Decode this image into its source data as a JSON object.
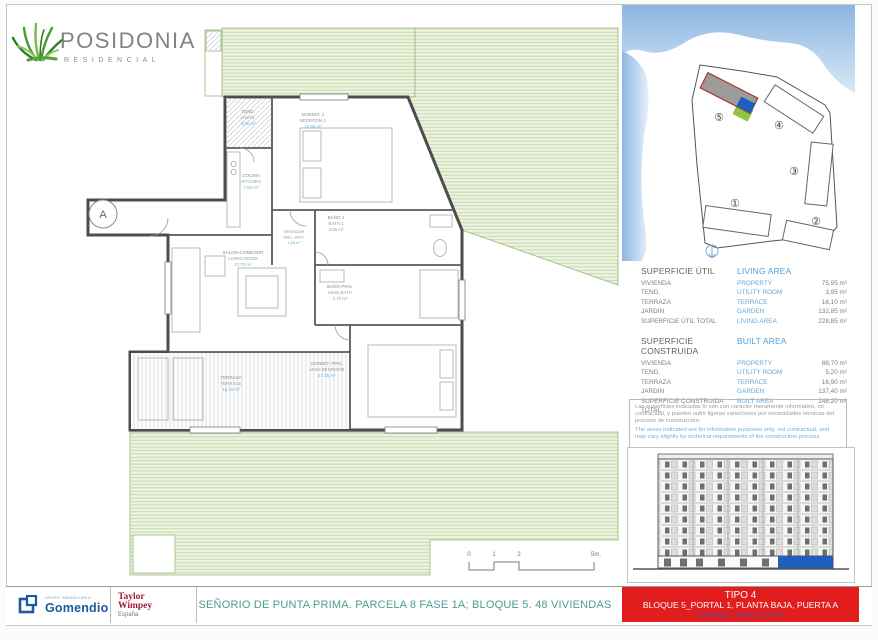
{
  "brand": {
    "name": "POSIDONIA",
    "subtitle": "RESIDENCIAL"
  },
  "floor_plan": {
    "rooms": {
      "tend": {
        "es": "TEND.",
        "en": "LAVAD.",
        "area": "3,95 m²"
      },
      "bedroom1": {
        "es": "DORMIT. 1",
        "en": "BEDROOM 1",
        "area": "10,85 m²"
      },
      "kitchen": {
        "es": "COCINA",
        "en": "KITCHEN",
        "area": "7,50 m²"
      },
      "bath1": {
        "es": "BAÑO 1",
        "en": "BATH 1",
        "area": "3,85 m²"
      },
      "wardrobe": {
        "es": "VESTIDOR",
        "en": "WALL WRD.",
        "area": "1,65 m²"
      },
      "living": {
        "es": "SALON-COMEDOR",
        "en": "LIVING ROOM",
        "area": "27,70 m²"
      },
      "mainbath": {
        "es": "BAÑO PPAL",
        "en": "MAIN BATH",
        "area": "3,70 m²"
      },
      "mainbed": {
        "es": "DORMIT. PPAL",
        "en": "MAIN BEDROOM",
        "area": "17,25 m²"
      },
      "terrace": {
        "es": "TERRAZA",
        "en": "TERRACE",
        "area": "16,10 m²"
      }
    },
    "entrance_label": "A",
    "scale_ticks": [
      "0",
      "1",
      "2",
      "5m."
    ]
  },
  "site_plan": {
    "blocks": [
      "①",
      "②",
      "③",
      "④",
      "⑤"
    ],
    "highlighted_block": "5"
  },
  "tables": {
    "util": {
      "title_es": "SUPERFICIE ÚTIL",
      "title_en": "LIVING AREA",
      "rows": [
        {
          "es": "VIVIENDA",
          "en": "PROPERTY",
          "value": "75,95 m²"
        },
        {
          "es": "TEND.",
          "en": "UTILITY ROOM",
          "value": "3,95 m²"
        },
        {
          "es": "TERRAZA",
          "en": "TERRACE",
          "value": "16,10 m²"
        },
        {
          "es": "JARDIN",
          "en": "GARDEN",
          "value": "132,85 m²"
        },
        {
          "es": "SUPERFICIE ÚTIL TOTAL",
          "en": "LIVING AREA",
          "value": "228,85 m²"
        }
      ]
    },
    "construida": {
      "title_es": "SUPERFICIE CONSTRUIDA",
      "title_en": "BUILT AREA",
      "rows": [
        {
          "es": "VIVIENDA",
          "en": "PROPERTY",
          "value": "88,70 m²"
        },
        {
          "es": "TEND.",
          "en": "UTILITY ROOM",
          "value": "5,20 m²"
        },
        {
          "es": "TERRAZA",
          "en": "TERRACE",
          "value": "16,90 m²"
        },
        {
          "es": "JARDIN",
          "en": "GARDEN",
          "value": "137,40 m²"
        },
        {
          "es": "SUPERFICIE CONSTRUIDA TOTAL",
          "en": "BUILT AREA",
          "value": "248,20 m²"
        }
      ]
    }
  },
  "disclaimer": {
    "es": "Las superficies indicadas lo son con carácter meramente informativo, no contractual, y pueden sufrir ligeras variaciones por necesidades técnicas del proceso de construcción.",
    "en": "The areas indicated are for information purposes only, not contractual, and may vary slightly by technical requirements of the construction process."
  },
  "footer": {
    "gomendio": {
      "name": "Gomendio",
      "sub": "GRUPO INMOBILIARIO"
    },
    "taylor": {
      "line1": "Taylor",
      "line2": "Wimpey",
      "line3": "España"
    },
    "sheet_title": "SEÑORIO DE PUNTA PRIMA. PARCELA 8 FASE 1A; BLOQUE 5. 48 VIVIENDAS",
    "unit_box": {
      "line1": "TIPO 4",
      "line2": "BLOQUE 5_PORTAL 1, PLANTA BAJA, PUERTA A",
      "line3": "Staircase 1, Floor 0, Door A"
    }
  },
  "colors": {
    "accent_blue": "#4d9fd6",
    "red_box": "#e21d1d",
    "sheet_title_green": "#4d9b94",
    "garden_green": "#c2d6a6",
    "gomendio_blue": "#1b5ba6",
    "taylor_red": "#9e1b32",
    "unit_marker_blue": "#1e5fbe",
    "garden_marker_green": "#8dc63f"
  }
}
